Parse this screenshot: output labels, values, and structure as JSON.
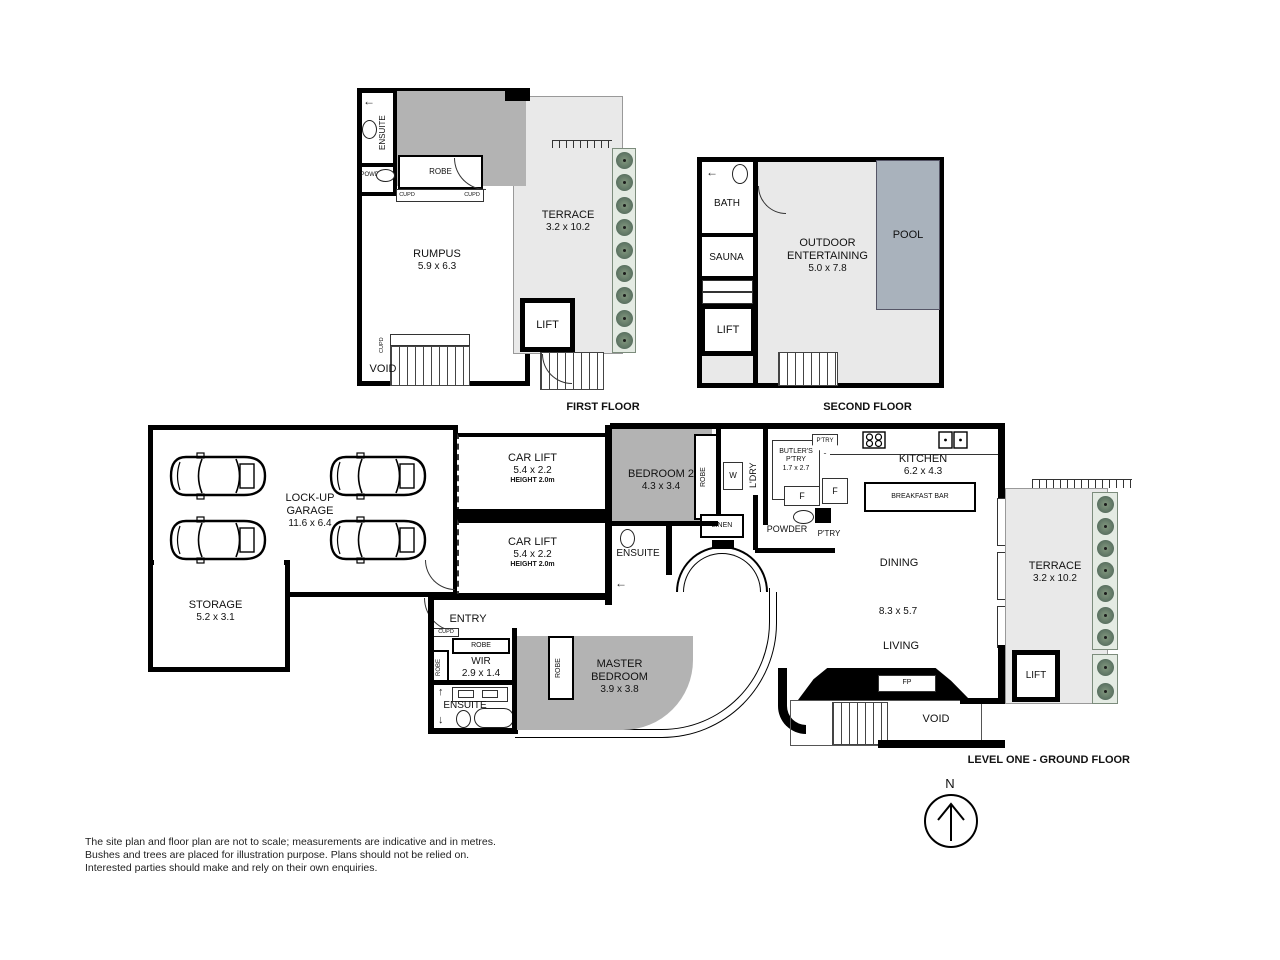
{
  "colors": {
    "wall": "#000000",
    "bedroom_fill": "#b3b3b3",
    "terrace_fill": "#e9e9e9",
    "pool_fill": "#a9b2bc",
    "plant": "#5d7463"
  },
  "icons": {
    "shower_arrow_left": "←",
    "arrow_up": "↑",
    "arrow_down": "↓"
  },
  "floors": {
    "first": {
      "title": "FIRST FLOOR",
      "bedroom3": {
        "name": "BEDROOM 3",
        "dims": "4.4 x 3.7"
      },
      "ensuite": "ENSUITE",
      "powder": "POWDER",
      "robe": "ROBE",
      "cupd_left": "CUPD",
      "cupd_right": "CUPD",
      "cupd_stair": "CUPD",
      "terrace": {
        "name": "TERRACE",
        "dims": "3.2 x 10.2"
      },
      "rumpus": {
        "name": "RUMPUS",
        "dims": "5.9 x 6.3"
      },
      "lift": "LIFT",
      "void": "VOID"
    },
    "second": {
      "title": "SECOND FLOOR",
      "bath": "BATH",
      "sauna": "SAUNA",
      "outdoor": {
        "name1": "OUTDOOR",
        "name2": "ENTERTAINING",
        "dims": "5.0 x 7.8"
      },
      "pool": "POOL",
      "lift": "LIFT"
    },
    "ground": {
      "title": "LEVEL ONE - GROUND FLOOR",
      "garage": {
        "name1": "LOCK-UP",
        "name2": "GARAGE",
        "dims": "11.6 x 6.4"
      },
      "storage": {
        "name": "STORAGE",
        "dims": "5.2 x 3.1"
      },
      "carlift1": {
        "name": "CAR LIFT",
        "dims": "5.4 x 2.2",
        "height": "HEIGHT 2.0m"
      },
      "carlift2": {
        "name": "CAR LIFT",
        "dims": "5.4 x 2.2",
        "height": "HEIGHT 2.0m"
      },
      "bedroom2": {
        "name": "BEDROOM 2",
        "dims": "4.3 x 3.4"
      },
      "robe_bed2": "ROBE",
      "w_label": "W",
      "ldry": "L'DRY",
      "linen": "LINEN",
      "ensuite_bed2": "ENSUITE",
      "butlers": {
        "name1": "BUTLER'S",
        "name2": "P'TRY",
        "dims": "1.7 x 2.7"
      },
      "f1": "F",
      "f2": "F",
      "ptry_small": "P'TRY",
      "powder": "POWDER",
      "ptry": "P'TRY",
      "kitchen": {
        "name": "KITCHEN",
        "dims": "6.2 x 4.3"
      },
      "breakfast_bar": "BREAKFAST BAR",
      "dining": "DINING",
      "living_dims": "8.3 x 5.7",
      "living": "LIVING",
      "fp": "FP",
      "void": "VOID",
      "terrace": {
        "name": "TERRACE",
        "dims": "3.2 x 10.2"
      },
      "lift": "LIFT",
      "entry": "ENTRY",
      "cupd": "CUPD",
      "robe_wir_top": "ROBE",
      "robe_wir_side": "ROBE",
      "wir": {
        "name": "WIR",
        "dims": "2.9 x 1.4"
      },
      "ensuite_master": "ENSUITE",
      "robe_master": "ROBE",
      "master": {
        "name1": "MASTER",
        "name2": "BEDROOM",
        "dims": "3.9 x 3.8"
      }
    }
  },
  "compass": {
    "label": "N"
  },
  "disclaimer": {
    "line1": "The site plan and floor plan are not to scale; measurements are indicative and in metres.",
    "line2": "Bushes and trees are placed for illustration purpose. Plans should not be relied on.",
    "line3": "Interested parties should make and rely on their own enquiries."
  }
}
